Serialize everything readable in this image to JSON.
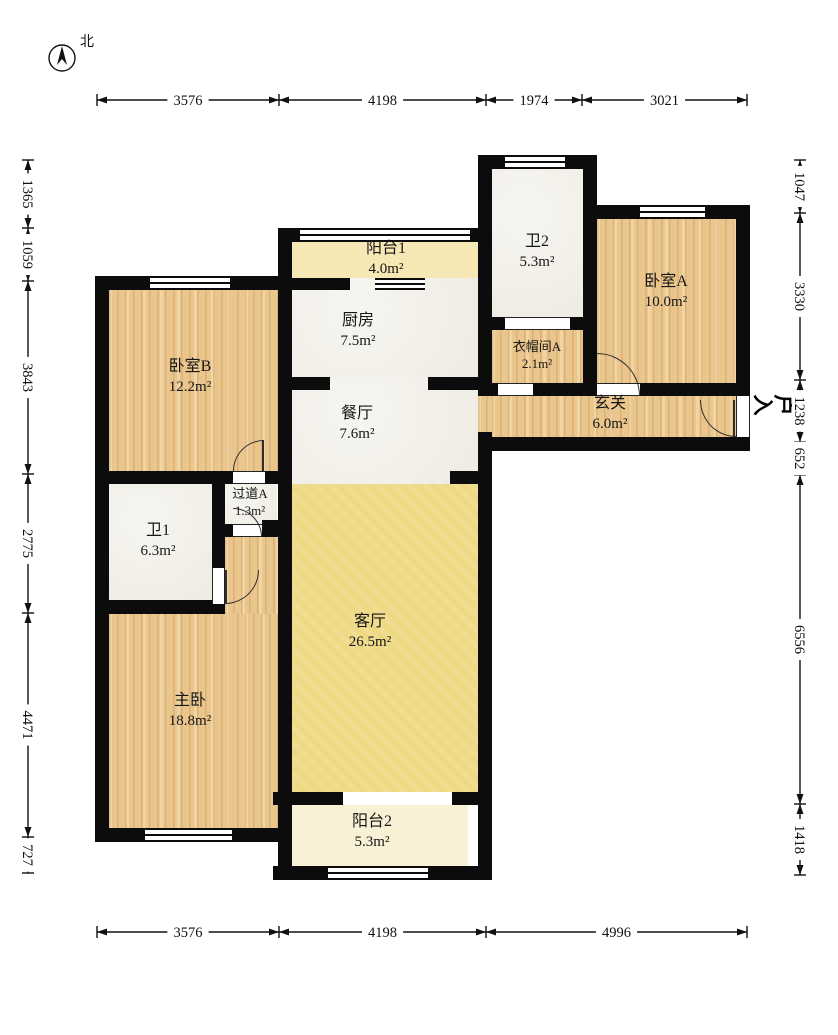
{
  "meta": {
    "width": 838,
    "height": 1035
  },
  "compass": {
    "label": "北"
  },
  "entry": {
    "label": "入户"
  },
  "rooms": [
    {
      "id": "balcony1",
      "name": "阳台1",
      "area": "4.0m²",
      "rect": [
        292,
        242,
        186,
        36
      ],
      "fill": "balc1",
      "label": [
        386,
        259
      ]
    },
    {
      "id": "bath2",
      "name": "卫2",
      "area": "5.3m²",
      "rect": [
        492,
        169,
        91,
        148
      ],
      "fill": "marble",
      "label": [
        537,
        252
      ]
    },
    {
      "id": "bedroomA",
      "name": "卧室A",
      "area": "10.0m²",
      "rect": [
        597,
        219,
        139,
        164
      ],
      "fill": "wood",
      "label": [
        666,
        292
      ]
    },
    {
      "id": "kitchen",
      "name": "厨房",
      "area": "7.5m²",
      "rect": [
        292,
        278,
        186,
        99
      ],
      "fill": "marble",
      "label": [
        358,
        331
      ]
    },
    {
      "id": "cloakroomA",
      "name": "衣帽间A",
      "area": "2.1m²",
      "rect": [
        492,
        330,
        91,
        53
      ],
      "fill": "wood",
      "label": [
        537,
        356
      ],
      "small": true
    },
    {
      "id": "foyer",
      "name": "玄关",
      "area": "6.0m²",
      "rect": [
        492,
        396,
        244,
        41
      ],
      "fill": "wood",
      "label": [
        610,
        414
      ]
    },
    {
      "id": "bedroomB",
      "name": "卧室B",
      "area": "12.2m²",
      "rect": [
        109,
        290,
        169,
        181
      ],
      "fill": "wood",
      "label": [
        190,
        377
      ]
    },
    {
      "id": "dining",
      "name": "餐厅",
      "area": "7.6m²",
      "rect": [
        292,
        377,
        186,
        107
      ],
      "fill": "marble",
      "label": [
        357,
        424
      ]
    },
    {
      "id": "hallwayA",
      "name": "过道A",
      "area": "1.3m²",
      "rect": [
        223,
        484,
        54,
        40
      ],
      "fill": "marble",
      "label": [
        250,
        503
      ],
      "small": true
    },
    {
      "id": "bath1",
      "name": "卫1",
      "area": "6.3m²",
      "rect": [
        109,
        484,
        103,
        116
      ],
      "fill": "marble",
      "label": [
        158,
        541
      ]
    },
    {
      "id": "master",
      "name": "主卧",
      "area": "18.8m²",
      "rect": [
        109,
        614,
        169,
        214
      ],
      "fill": "wood",
      "label": [
        190,
        711
      ]
    },
    {
      "id": "living",
      "name": "客厅",
      "area": "26.5m²",
      "rect": [
        292,
        484,
        186,
        308
      ],
      "fill": "living",
      "label": [
        370,
        632
      ]
    },
    {
      "id": "balcony2",
      "name": "阳台2",
      "area": "5.3m²",
      "rect": [
        287,
        805,
        181,
        61
      ],
      "fill": "balc2",
      "label": [
        372,
        832
      ]
    }
  ],
  "patches": [
    {
      "rect": [
        225,
        537,
        53,
        77
      ],
      "fill": "wood"
    },
    {
      "rect": [
        478,
        396,
        14,
        36
      ],
      "fill": "wood"
    }
  ],
  "walls": [
    [
      95,
      276,
      14,
      566
    ],
    [
      95,
      276,
      183,
      14
    ],
    [
      278,
      228,
      14,
      652
    ],
    [
      95,
      471,
      183,
      13
    ],
    [
      212,
      484,
      13,
      130
    ],
    [
      95,
      600,
      130,
      14
    ],
    [
      212,
      524,
      21,
      13
    ],
    [
      262,
      520,
      26,
      17
    ],
    [
      95,
      828,
      190,
      14
    ],
    [
      278,
      228,
      214,
      14
    ],
    [
      292,
      278,
      58,
      12
    ],
    [
      292,
      377,
      38,
      13
    ],
    [
      428,
      377,
      50,
      13
    ],
    [
      450,
      471,
      28,
      13
    ],
    [
      478,
      155,
      14,
      241
    ],
    [
      478,
      432,
      14,
      448
    ],
    [
      273,
      792,
      70,
      13
    ],
    [
      452,
      792,
      40,
      13
    ],
    [
      273,
      866,
      55,
      14
    ],
    [
      428,
      866,
      64,
      14
    ],
    [
      478,
      155,
      119,
      14
    ],
    [
      583,
      155,
      14,
      241
    ],
    [
      583,
      205,
      167,
      14
    ],
    [
      736,
      205,
      14,
      191
    ],
    [
      478,
      317,
      119,
      13
    ],
    [
      478,
      383,
      20,
      13
    ],
    [
      533,
      383,
      64,
      13
    ],
    [
      640,
      383,
      110,
      13
    ],
    [
      478,
      437,
      272,
      14
    ]
  ],
  "windows": [
    [
      150,
      276,
      80,
      14
    ],
    [
      300,
      228,
      170,
      14
    ],
    [
      505,
      155,
      60,
      14
    ],
    [
      640,
      205,
      65,
      14
    ],
    [
      375,
      278,
      50,
      12
    ],
    [
      145,
      828,
      87,
      14
    ],
    [
      328,
      866,
      100,
      14
    ]
  ],
  "thresholds_h": [
    [
      233,
      471,
      32,
      13
    ],
    [
      233,
      524,
      29,
      13
    ],
    [
      505,
      317,
      65,
      13
    ],
    [
      498,
      383,
      35,
      13
    ],
    [
      597,
      383,
      43,
      13
    ]
  ],
  "thresholds_v": [
    [
      212,
      568,
      13,
      36
    ],
    [
      736,
      396,
      14,
      41
    ]
  ],
  "doors": [
    {
      "box": [
        233,
        440,
        31,
        31
      ],
      "corner": "tl",
      "leaf": [
        262,
        440,
        2,
        31
      ]
    },
    {
      "box": [
        233,
        508,
        29,
        29
      ],
      "corner": "tr"
    },
    {
      "box": [
        225,
        570,
        34,
        34
      ],
      "corner": "br",
      "leaf": [
        225,
        570,
        2,
        34
      ]
    },
    {
      "box": [
        597,
        353,
        43,
        43
      ],
      "corner": "tr"
    },
    {
      "box": [
        700,
        400,
        36,
        37
      ],
      "corner": "bl",
      "leaf": [
        733,
        400,
        2,
        37
      ]
    }
  ],
  "dimensions": {
    "top": {
      "axis": "h",
      "pos": 100,
      "ticks": [
        97,
        279,
        486,
        582,
        747
      ],
      "labels": [
        "3576",
        "4198",
        "1974",
        "3021"
      ]
    },
    "bottom": {
      "axis": "h",
      "pos": 932,
      "ticks": [
        97,
        279,
        486,
        747
      ],
      "labels": [
        "3576",
        "4198",
        "4996"
      ]
    },
    "left": {
      "axis": "v",
      "pos": 28,
      "ticks": [
        160,
        228,
        281,
        474,
        613,
        837,
        873
      ],
      "labels": [
        "1365",
        "1059",
        "3843",
        "2775",
        "4471",
        "727"
      ]
    },
    "right": {
      "axis": "v",
      "pos": 800,
      "ticks": [
        160,
        213,
        380,
        442,
        475,
        804,
        875
      ],
      "labels": [
        "1047",
        "3330",
        "1238",
        "652",
        "6556",
        "1418"
      ]
    }
  }
}
